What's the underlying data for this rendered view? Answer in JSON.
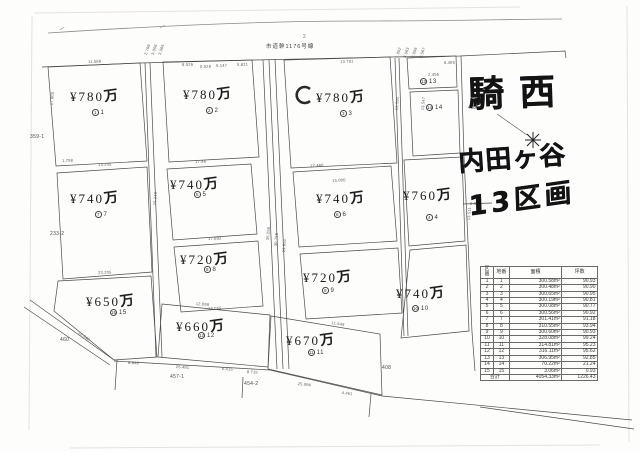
{
  "handwriting": {
    "line1": "騎西",
    "line2": "内田ヶ谷",
    "line3": "13区画"
  },
  "labels": {
    "road": "市道幹1176号線",
    "road_mark": "2",
    "benchmark": "402",
    "lot_left_upper": "359-1",
    "lot_left_lower": "233-2",
    "lot_bottom_left": "460",
    "lot_bottom_1": "457-1",
    "lot_bottom_2": "454-2",
    "lot_bottom_right": "408"
  },
  "plots": [
    {
      "id": "1",
      "lot": "1",
      "yen": "¥780",
      "unit": "万"
    },
    {
      "id": "2",
      "lot": "2",
      "yen": "¥780",
      "unit": "万"
    },
    {
      "id": "3",
      "lot": "3",
      "yen": "¥780",
      "unit": "万"
    },
    {
      "id": "4",
      "lot": "4",
      "yen": "¥760",
      "unit": "万"
    },
    {
      "id": "5",
      "lot": "5",
      "yen": "¥740",
      "unit": "万"
    },
    {
      "id": "6",
      "lot": "6",
      "yen": "¥740",
      "unit": "万"
    },
    {
      "id": "7",
      "lot": "7",
      "yen": "¥740",
      "unit": "万"
    },
    {
      "id": "8",
      "lot": "8",
      "yen": "¥720",
      "unit": "万"
    },
    {
      "id": "9",
      "lot": "9",
      "yen": "¥720",
      "unit": "万"
    },
    {
      "id": "10",
      "lot": "10",
      "yen": "¥740",
      "unit": "万"
    },
    {
      "id": "11",
      "lot": "11",
      "yen": "¥670",
      "unit": "万"
    },
    {
      "id": "12",
      "lot": "12",
      "yen": "¥660",
      "unit": "万"
    },
    {
      "id": "13",
      "lot": "13",
      "yen": "",
      "unit": ""
    },
    {
      "id": "14",
      "lot": "14",
      "yen": "",
      "unit": ""
    },
    {
      "id": "15",
      "lot": "15",
      "yen": "¥650",
      "unit": "万"
    }
  ],
  "table": {
    "headers": [
      "区画",
      "地番",
      "面積",
      "坪数"
    ],
    "rows": [
      [
        "1",
        "1",
        "300.58m²",
        "90.93"
      ],
      [
        "2",
        "2",
        "300.48m²",
        "90.90"
      ],
      [
        "3",
        "3",
        "300.65m²",
        "90.95"
      ],
      [
        "4",
        "4",
        "300.19m²",
        "90.81"
      ],
      [
        "5",
        "5",
        "300.08m²",
        "90.77"
      ],
      [
        "6",
        "6",
        "300.56m²",
        "90.92"
      ],
      [
        "7",
        "7",
        "301.41m²",
        "91.18"
      ],
      [
        "8",
        "8",
        "310.55m²",
        "93.94"
      ],
      [
        "9",
        "9",
        "300.60m²",
        "90.93"
      ],
      [
        "10",
        "10",
        "328.08m²",
        "99.24"
      ],
      [
        "11",
        "11",
        "314.81m²",
        "95.23"
      ],
      [
        "12",
        "12",
        "316.11m²",
        "95.62"
      ],
      [
        "13",
        "13",
        "306.95m²",
        "92.85"
      ],
      [
        "14",
        "14",
        "70.22m²",
        "21.24"
      ],
      [
        "15",
        "15",
        "3.06m²",
        "0.93"
      ]
    ],
    "total_label": "合計",
    "total_area": "4054.33m²",
    "total_tsubo": "1226.43"
  },
  "dimensions": [
    "11.586",
    "2.768",
    "3.056",
    "3.084",
    "6.526",
    "0.528",
    "5.147",
    "5.821",
    "13.791",
    "1.052",
    "3.063",
    "2.056",
    "3.567",
    "6.485",
    "2.456",
    "17.805",
    "1.798",
    "13.205",
    "17.46",
    "17.460",
    "15.000",
    "13.591",
    "13.547",
    "8.007",
    "13.511",
    "15.240",
    "35.256",
    "30.756",
    "24.851",
    "17.892",
    "23.205",
    "11.546",
    "17.055",
    "12.098",
    "9.940",
    "12.342",
    "25.481",
    "6.415",
    "8.715",
    "25.096",
    "4.461"
  ]
}
